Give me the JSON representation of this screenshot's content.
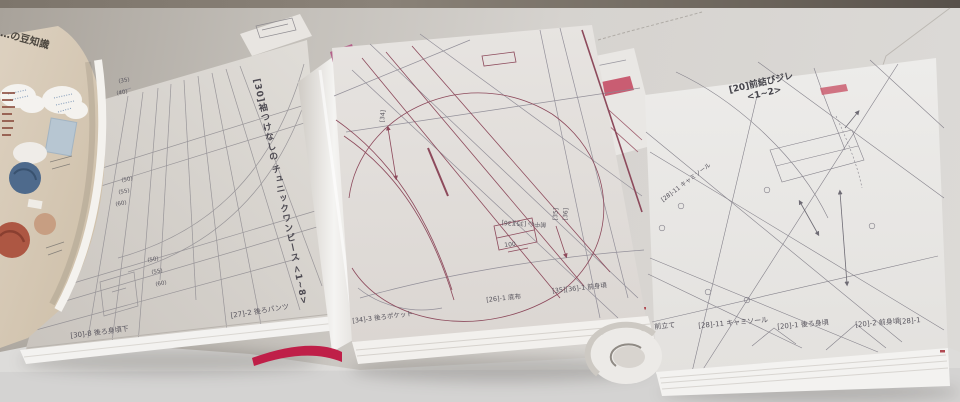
{
  "left_book": {
    "info_page": {
      "title": "…の豆知識"
    },
    "pattern_page": {
      "title_vertical": [
        "[30]袖つけなしの",
        "チュニックワンピース",
        "<1~8>"
      ],
      "size_marks_upper": [
        "(35)",
        "(40)"
      ],
      "size_marks_mid": [
        "(50)",
        "(55)",
        "(60)"
      ],
      "size_marks_lower": [
        "(50)",
        "(55)",
        "(60)"
      ],
      "piece_label_left": "[30]-8 後ろ身頃下",
      "piece_label_right": "[27]-2 後ろパンツ"
    }
  },
  "middle_book": {
    "pattern_page": {
      "annotation_34": "[34]",
      "annotation_center_front": "前中心 [35][36]",
      "annotation_35": "[35]",
      "annotation_36": "[36]",
      "annotation_100": "100",
      "piece_label_left": "[34]-3 後ろポケット",
      "piece_label_center": "[26]-1 底布",
      "piece_label_right": "[35][36]-1 前身頃"
    }
  },
  "right_book": {
    "pattern_page": {
      "title_lines": [
        "[20]前結びジレ",
        "<1~2>"
      ],
      "annotation_camisole": "[28]-11 キャミソール",
      "piece_labels": [
        "前立て",
        "[28]-11 キャミソール",
        "[20]-1 後ろ身頃",
        "[20]-2 前身頃",
        "[28]-1"
      ]
    }
  },
  "colors": {
    "pattern_line_maroon": "#8d4a5c",
    "pattern_line_gray": "#86838c",
    "spine_band_pink": "#b4618a",
    "cover_red": "#bf1f48",
    "fabric_blue": "#4e6a8c",
    "fabric_rust": "#ad5743"
  }
}
